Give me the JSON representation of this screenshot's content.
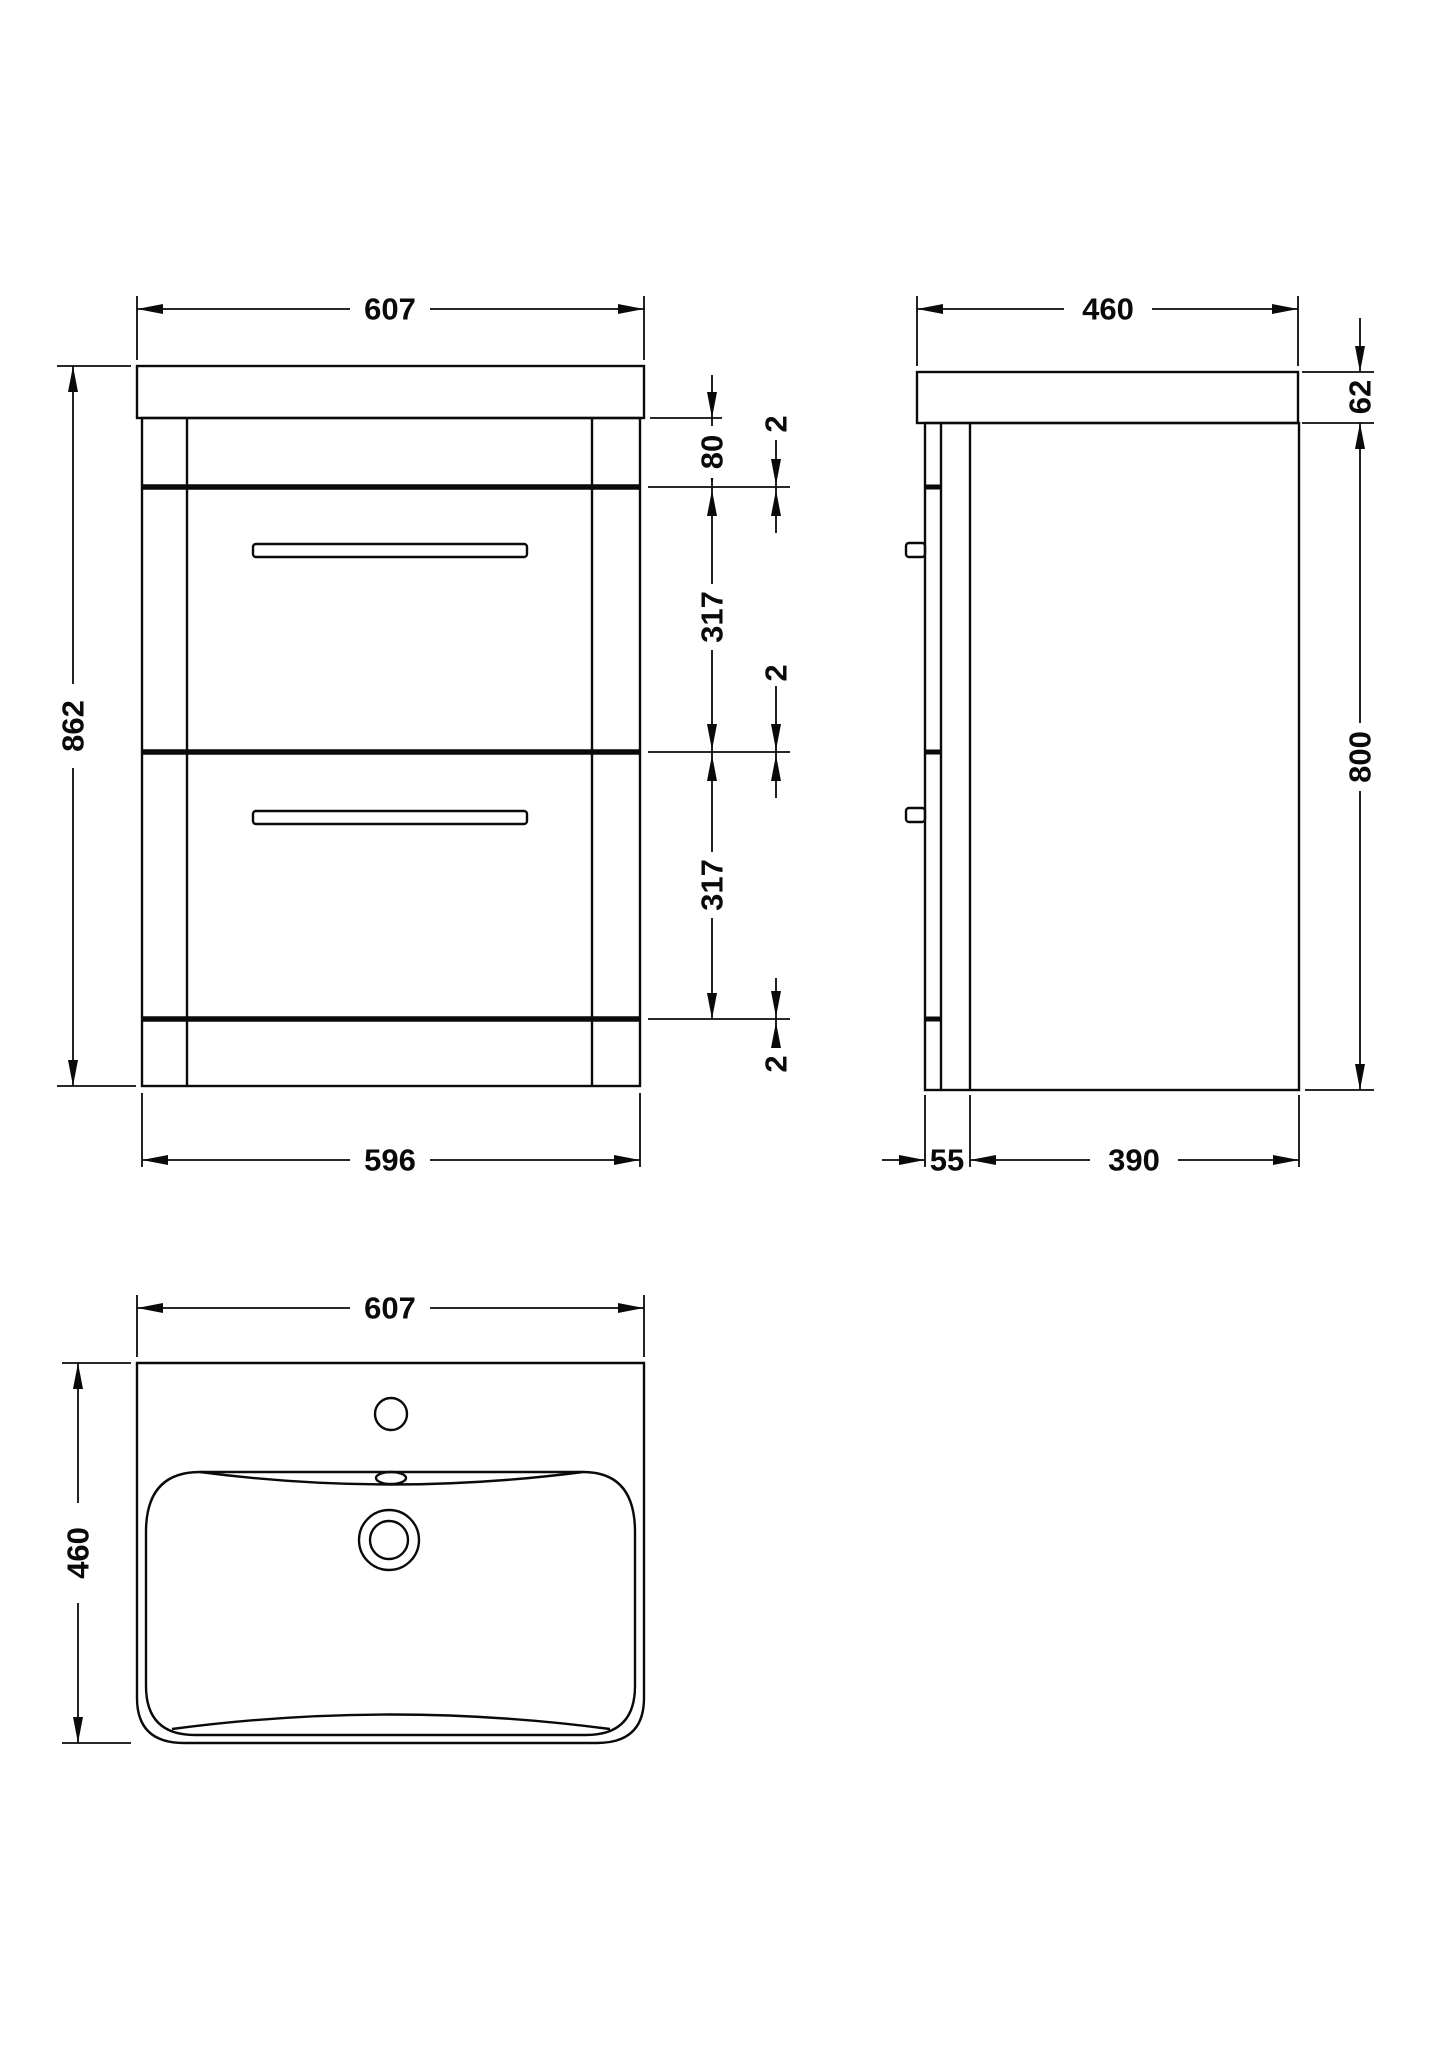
{
  "page": {
    "background_color": "#ffffff",
    "line_color": "#0a0a0a"
  },
  "views": {
    "front": {
      "dim_width_top": "607",
      "dim_height": "862",
      "dim_top_rail": "80",
      "dim_gap_top": "2",
      "dim_drawer1": "317",
      "dim_gap_mid": "2",
      "dim_drawer2": "317",
      "dim_gap_bottom": "2",
      "dim_width_bottom": "596"
    },
    "side": {
      "dim_depth": "460",
      "dim_worktop_thickness": "62",
      "dim_body_height": "800",
      "dim_front_section": "55",
      "dim_body_depth": "390"
    },
    "plan": {
      "dim_width": "607",
      "dim_depth": "460"
    }
  }
}
